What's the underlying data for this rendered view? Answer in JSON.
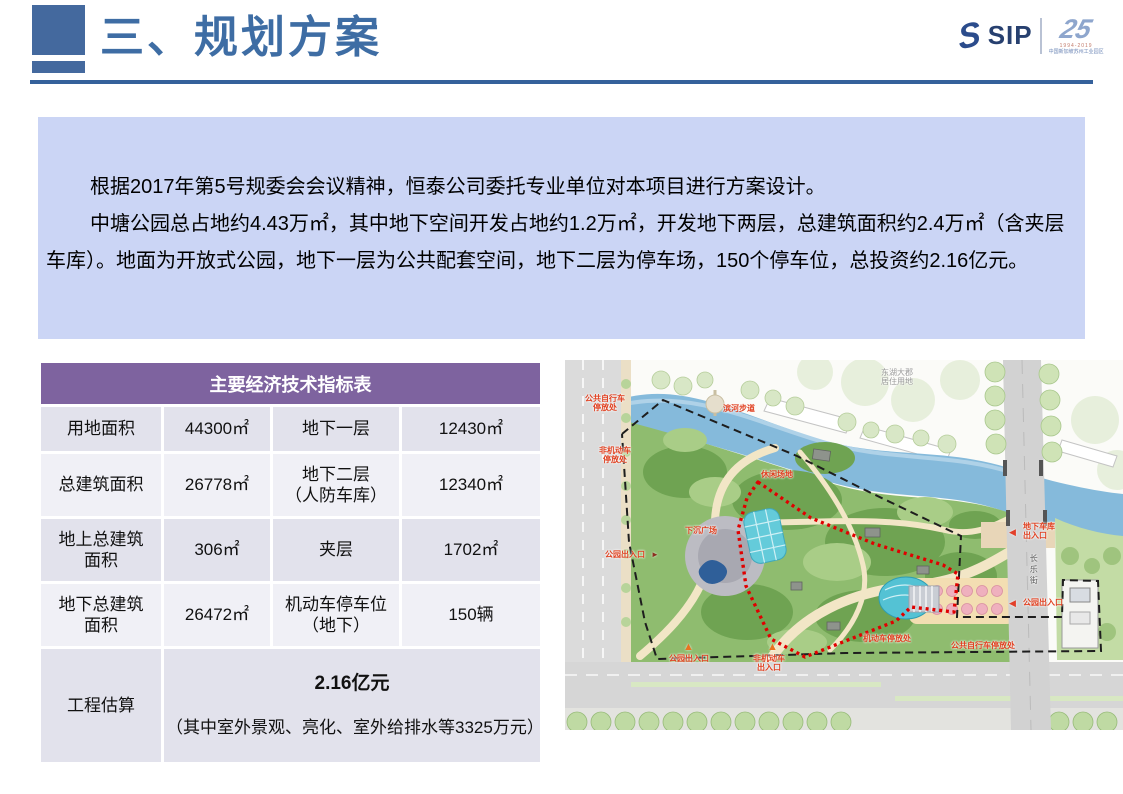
{
  "header": {
    "title": "三、规划方案",
    "accent_color": "#3E6DA4",
    "logo": {
      "swoosh": "S",
      "sip": "SIP",
      "anniversary": "25",
      "years": "1994-2019",
      "org": "中国新加坡苏州工业园区"
    }
  },
  "intro": {
    "bg_color": "#CBD5F5",
    "paragraph1": "根据2017年第5号规委会会议精神，恒泰公司委托专业单位对本项目进行方案设计。",
    "paragraph2": "中塘公园总占地约4.43万㎡，其中地下空间开发占地约1.2万㎡，开发地下两层，总建筑面积约2.4万㎡（含夹层车库）。地面为开放式公园，地下一层为公共配套空间，地下二层为停车场，150个停车位，总投资约2.16亿元。"
  },
  "table": {
    "title": "主要经济技术指标表",
    "header_bg": "#7E639F",
    "rows": [
      {
        "cells": [
          "用地面积",
          "44300㎡",
          "地下一层",
          "12430㎡"
        ]
      },
      {
        "cells": [
          "总建筑面积",
          "26778㎡",
          "地下二层\n（人防车库）",
          "12340㎡"
        ]
      },
      {
        "cells": [
          "地上总建筑\n面积",
          "306㎡",
          "夹层",
          "1702㎡"
        ]
      },
      {
        "cells": [
          "地下总建筑\n面积",
          "26472㎡",
          "机动车停车位\n（地下）",
          "150辆"
        ]
      }
    ],
    "estimate": {
      "label": "工程估算",
      "value": "2.16亿元",
      "note": "（其中室外景观、亮化、室外给排水等3325万元）"
    }
  },
  "map": {
    "labels": {
      "bike_parking_nw": "公共自行车\n停放处",
      "non_motor_parking": "非机动车\n停放处",
      "riverside_walk": "滨河步道",
      "leisure_area": "休闲场地",
      "sunken_plaza": "下沉广场",
      "garage_entrance": "地下车库\n出入口",
      "park_entrance_west": "公园出入口",
      "park_entrance_south": "公园出入口",
      "non_motor_entrance": "非机动车\n出入口",
      "park_entrance_east": "公园出入口",
      "motor_parking": "机动车停放处",
      "bike_parking_se": "公共自行车停放处",
      "street_changle": "长乐街",
      "residential": "东湖大郡\n居住用地"
    },
    "icons": {
      "up_arrow": "▲",
      "left_arrow": "◀",
      "right_arrow": "►"
    },
    "boundary_colors": {
      "site_dashed": "#1E1E1E",
      "underground_dotted": "#E00000"
    }
  }
}
